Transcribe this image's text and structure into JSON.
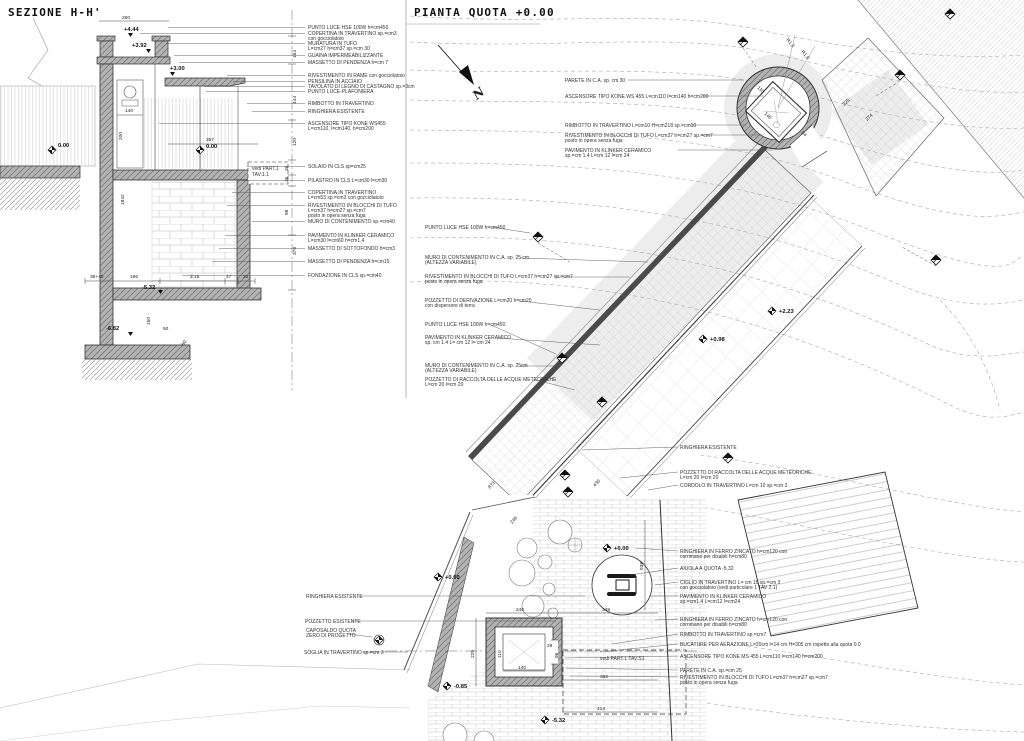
{
  "titles": {
    "section": "SEZIONE H-H'",
    "plan": "PIANTA QUOTA +0.00"
  },
  "north": "N",
  "sec": {
    "callouts": [
      [
        "PUNTO LUCE HSE 100W h=cm450"
      ],
      [
        "COPERTINA IN TRAVERTINO sp.=cm3",
        "con gocciolatoio"
      ],
      [
        "MURATURA IN TUFO",
        "L=cm27 h=cm37 sp.=cm 30"
      ],
      [
        "GUAINA IMPERMEABILIZZANTE"
      ],
      [
        "MASSETTO DI PENDENZA h=cm 7"
      ],
      [
        "RIVESTIMENTO IN RAME con gocciolatoio"
      ],
      [
        "PENSILINA IN ACCIAIO"
      ],
      [
        "TAVOLATO DI LEGNO DI CASTAGNO sp.=3cm"
      ],
      [
        "PUNTO LUCE-PLAFONIERA"
      ],
      [
        "RIMBOTTO IN TRAVERTINO"
      ],
      [
        "RINGHIERA ESISTENTE"
      ],
      [
        "ASCENSORE TIPO KONE WS455",
        "L=cm110, l=cm140, h=cm200"
      ],
      [
        "SOLAIO IN CLS sp=cm25"
      ],
      [
        "PILASTRO IN CLS L=cm30 l=cm30"
      ],
      [
        "COPERTINA IN TRAVERTINO",
        "L=cm53 sp.=cm3 con gocciolatoio"
      ],
      [
        "RIVESTIMENTO IN BLOCCHI DI TUFO",
        "L=cm37 h=cm27 sp.=cm7",
        "posto in opera senza fuga"
      ],
      [
        "MURO DI CONTENIMENTO sp.=cm40"
      ],
      [
        "PAVIMENTO IN KLINKER CERAMICO",
        "L=cm30 l=cm60 h=cm1.4"
      ],
      [
        "MASSETTO DI SOTTOFONDO h=cm3"
      ],
      [
        "MASSETTO DI PENDENZA h=cm15"
      ],
      [
        "FONDAZIONE IN CLS sp.=cm40"
      ]
    ],
    "dims": [
      "260",
      "+4.44",
      "+3.92",
      "+3.00",
      "140",
      "200",
      "357",
      "0.00",
      "0.00",
      "1842",
      "39+40",
      "196",
      "2.15",
      "47",
      "20",
      "-5.32",
      "150",
      "-6.82",
      "50",
      "60",
      "164",
      "444",
      "120",
      "36",
      "36",
      "98",
      "378"
    ],
    "note": [
      "vedi PART.1",
      "TAV.1.1"
    ]
  },
  "pl": {
    "nw": [
      [
        "PARETE IN C.A. sp. cm 30"
      ],
      [
        "ASCENSORE TIPO KONE WS 455 L=cm110 l=cm140 h=cm200"
      ],
      [
        "RIMBOTTO IN TRAVERTINO L=cm10 H=cm218 sp.=cm10"
      ],
      [
        "RIVESTIMENTO IN BLOCCHI DI TUFO L=cm37 h=cm27 sp.=cm7",
        "posto in opera senza fuga"
      ],
      [
        "PAVIMENTO IN KLINKER CERAMICO",
        "sp.=cm 1.4 L=cm 12 l=cm 24"
      ]
    ],
    "w": [
      [
        "PUNTO LUCE HSE 100W h=cm450"
      ],
      [
        "MURO DI CONTENIMENTO IN C.A. sp. 25 cm",
        "(ALTEZZA VARIABILE)"
      ],
      [
        "RIVESTIMENTO IN BLOCCHI DI TUFO L=cm37 h=cm27 sp.=cm7",
        "posto in opera senza fuga"
      ],
      [
        "POZZETTO DI DERIVAZIONE L=cm20 h=cm20",
        "con dispersore di terra"
      ],
      [
        "PUNTO LUCE HSE 100W h=cm450"
      ],
      [
        "PAVIMENTO IN KLINKER CERAMICO",
        "sp. cm 1.4 L= cm 12 l= cm 24"
      ],
      [
        "MURO DI CONTENIMENTO IN C.A. sp. 25cm",
        "(ALTEZZA VARIABILE)"
      ],
      [
        "POZZETTO DI RACCOLTA DELLE ACQUE METEORICHE",
        "L=cm 20 l=cm 20"
      ]
    ],
    "se": [
      [
        "RINGHIERA ESISTENTE"
      ],
      [
        "POZZETTO DI RACCOLTA DELLE ACQUE METEORICHE",
        "L=cm 20 l=cm 20"
      ],
      [
        "CORDOLO IN TRAVERTINO L=cm 10 sp.=cm 3"
      ],
      [
        "RINGHIERA IN FERRO ZINCATO h=cm120 con",
        "corrimano per disabili h=cm80"
      ],
      [
        "AIUOLA A QUOTA -5.32"
      ],
      [
        "CIGLIO IN TRAVERTINO L= cm 15 sp.=cm 3",
        "con gocciolatoio (vedi particolare 1 TAV 2.1)"
      ],
      [
        "PAVIMENTO IN KLINKER CERAMICO",
        "sp.=cm1.4 L=cm12 l=cm24"
      ],
      [
        "RINGHIERA IN FERRO ZINCATO h=cm120 con",
        "corrimano per disabili h=cm80"
      ],
      [
        "RIMBOTTO IN TRAVERTINO sp.=cm7"
      ],
      [
        "BUCATURE PER AERAZIONE L=20cm l=14 cm H=305 cm rispetto alla quota 0.0"
      ],
      [
        "ASCENSORE TIPO KONE MS 455 L=cm110 l=cm140 h=cm200"
      ],
      [
        "PARETE IN C.A. sp.=cm 25"
      ],
      [
        "RIVESTIMENTO IN BLOCCHI DI TUFO L=cm37 h=cm27 sp.=cm7",
        "posto in opera senza fuga"
      ]
    ],
    "sw": [
      [
        "RINGHIERA ESISTENTE"
      ],
      [
        "POZZETTO ESISTENTE"
      ],
      [
        "CAPOSALDO QUOTA",
        "ZERO DI PROGETTO"
      ],
      [
        "SOGLIA IN TRAVERTINO sp.=cm 3"
      ]
    ],
    "levels": [
      "+2.23",
      "+0.98",
      "+0.00",
      "+0.00",
      "-0.85",
      "-5.32"
    ],
    "dims": [
      "110",
      "140",
      "84",
      "R1.3",
      "R1.6",
      "225",
      "274",
      "873",
      "249",
      "430",
      "246",
      "349",
      "938",
      "225",
      "110",
      "140",
      "28",
      "96",
      "362",
      "414"
    ],
    "note": "vedi PART.1 TAV.S1"
  }
}
